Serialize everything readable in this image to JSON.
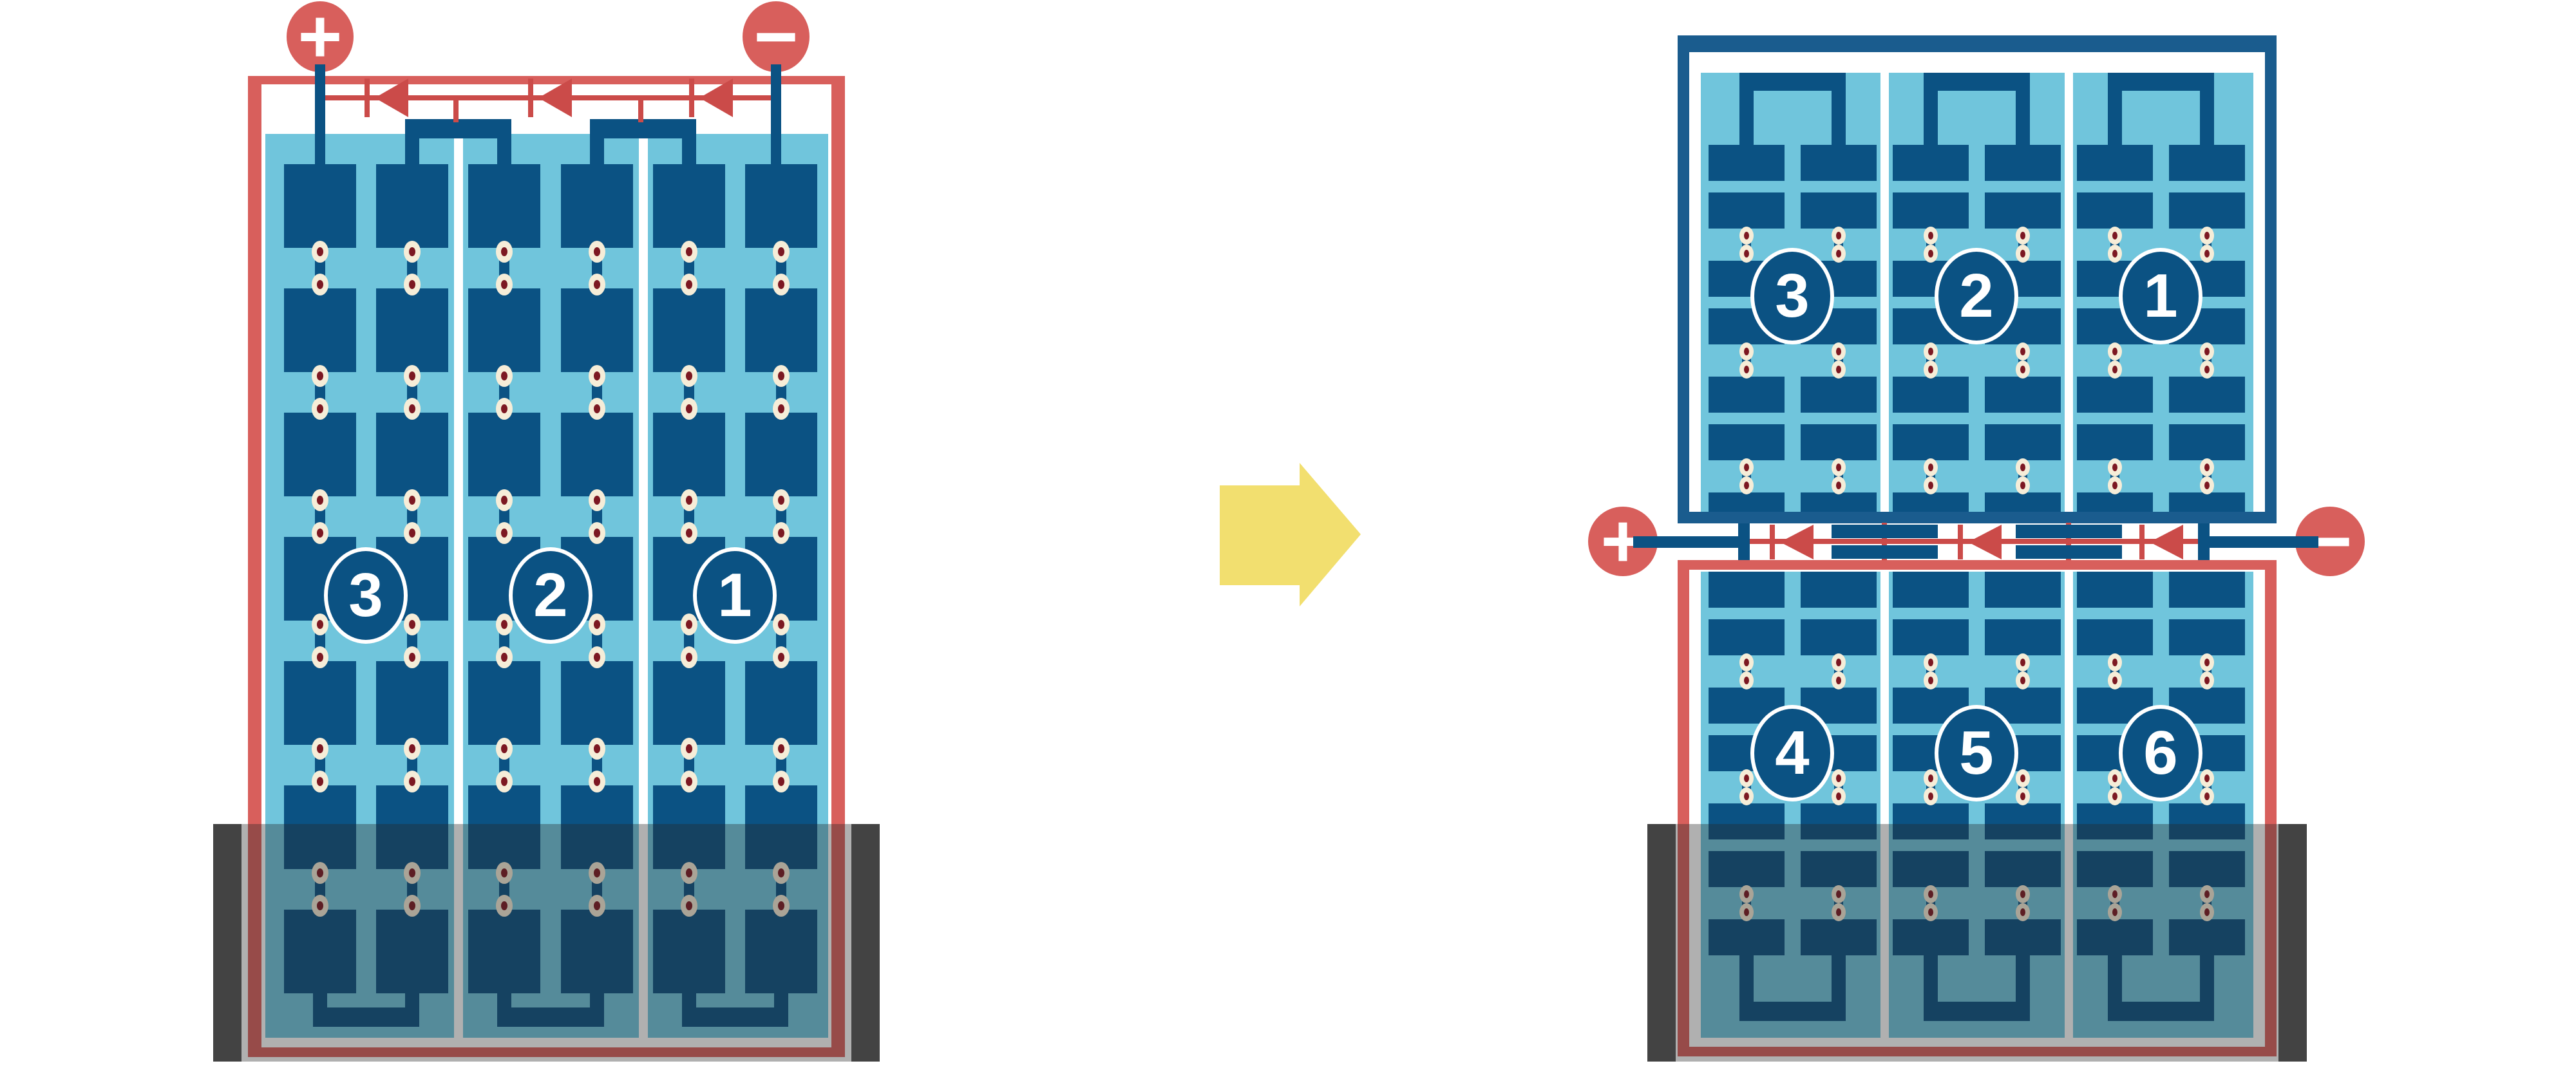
{
  "colors": {
    "background": "#FFFFFF",
    "frame_red": "#D85F5C",
    "wire_red": "#CB4B49",
    "navy": "#0B5283",
    "navy_frame": "#1A5C8E",
    "panel_blue": "#70C5DC",
    "dot_cream": "#F6EDD8",
    "dot_core": "#7C1822",
    "cap_gray": "#434343",
    "shade_overlay": "rgba(40,40,40,0.37)",
    "arrow_yellow": "#F2DF6F",
    "circle_text": "#FFFFFF"
  },
  "left_module": {
    "positive_terminal": "+",
    "negative_terminal": "−",
    "string_labels": [
      "3",
      "2",
      "1"
    ],
    "bypass_diode_count": 3
  },
  "arrow": {
    "icon": "arrow-right"
  },
  "right_assembly": {
    "positive_terminal": "+",
    "negative_terminal": "−",
    "top_module_string_labels": [
      "3",
      "2",
      "1"
    ],
    "bottom_module_string_labels": [
      "4",
      "5",
      "6"
    ],
    "bypass_diode_count": 3
  }
}
